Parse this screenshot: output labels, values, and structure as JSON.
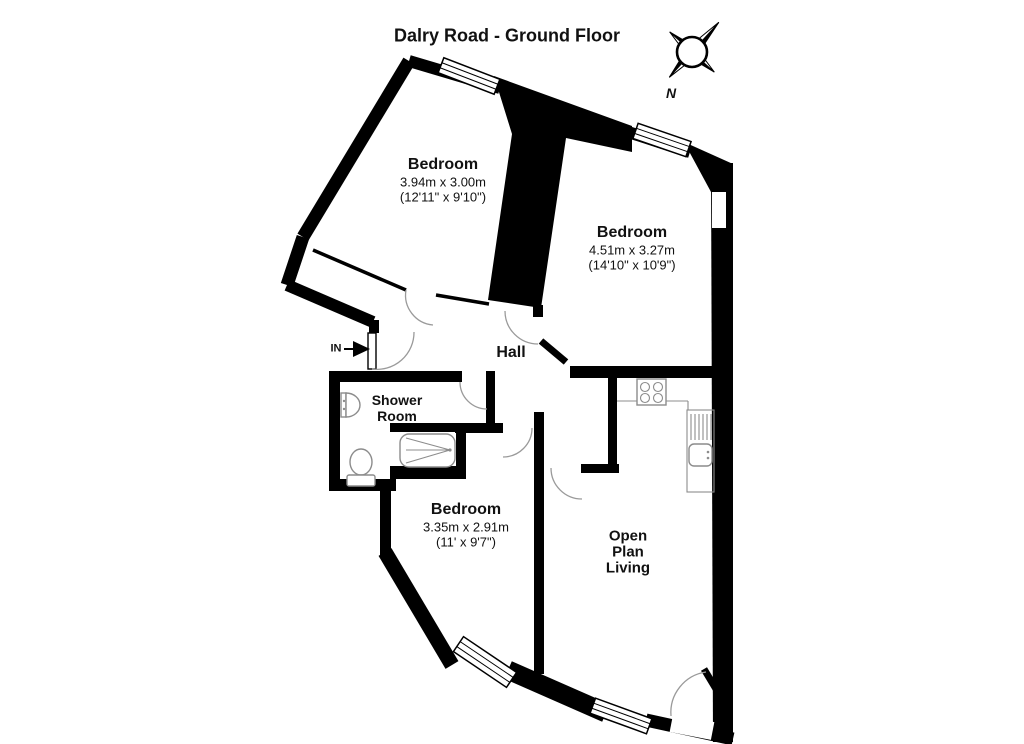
{
  "title": "Dalry Road - Ground Floor",
  "compass": {
    "north_label": "N"
  },
  "entrance": {
    "label": "IN"
  },
  "rooms": {
    "bedroom_top_left": {
      "name": "Bedroom",
      "size_metric": "3.94m x 3.00m",
      "size_imperial": "(12'11\" x 9'10\")"
    },
    "bedroom_top_right": {
      "name": "Bedroom",
      "size_metric": "4.51m x 3.27m",
      "size_imperial": "(14'10\" x 10'9\")"
    },
    "hall": {
      "name": "Hall"
    },
    "shower_room": {
      "line1": "Shower",
      "line2": "Room"
    },
    "bedroom_bottom": {
      "name": "Bedroom",
      "size_metric": "3.35m x 2.91m",
      "size_imperial": "(11' x 9'7\")"
    },
    "open_plan_living": {
      "line1": "Open",
      "line2": "Plan",
      "line3": "Living"
    }
  },
  "colors": {
    "wall": "#000000",
    "background": "#ffffff",
    "fixture_outline": "#8c8c8c",
    "door_arc": "#9a9a9a"
  }
}
